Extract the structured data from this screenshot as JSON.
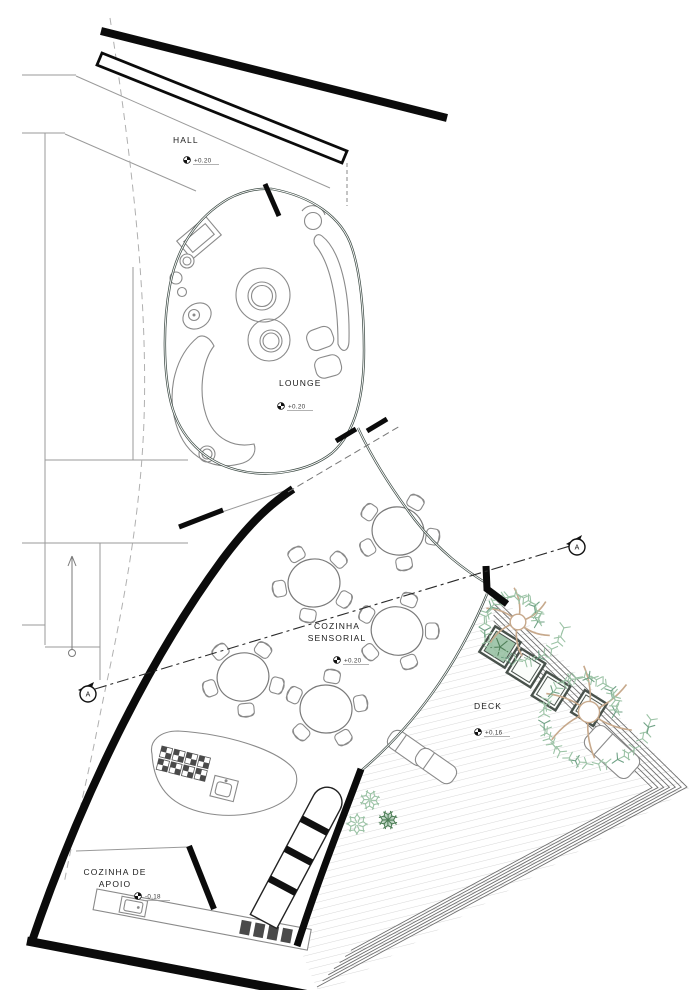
{
  "rooms": {
    "hall": {
      "name": "HALL",
      "level": "+0.20"
    },
    "lounge": {
      "name": "LOUNGE",
      "level": "+0.20"
    },
    "sensorial": {
      "line1": "COZINHA",
      "line2": "SENSORIAL",
      "level": "+0.20"
    },
    "deck": {
      "name": "DECK",
      "level": "+0.16"
    },
    "apoio": {
      "line1": "COZINHA DE",
      "line2": "APOIO",
      "level": "-0.18"
    }
  },
  "section": {
    "label": "A"
  },
  "colors": {
    "wall": "#0b0b0b",
    "glass": "#3f4d47",
    "foliage_light": "#9cc3a6",
    "foliage_dark": "#6fa185",
    "bush_dark": "#4f7f58",
    "branch": "#c7a98c",
    "planter": "#49524c",
    "deck_hatch": "#d8d8d8"
  },
  "plan": {
    "tables": [
      {
        "cx": 398,
        "cy": 531,
        "rx": 26,
        "ry": 24,
        "rot": 12,
        "chairs": [
          -60,
          10,
          80,
          150,
          215
        ]
      },
      {
        "cx": 314,
        "cy": 583,
        "rx": 26,
        "ry": 24,
        "rot": -8,
        "chairs": [
          -45,
          30,
          100,
          170,
          240
        ]
      },
      {
        "cx": 397,
        "cy": 631,
        "rx": 26,
        "ry": 24,
        "rot": 20,
        "chairs": [
          -70,
          0,
          70,
          140,
          210
        ]
      },
      {
        "cx": 243,
        "cy": 677,
        "rx": 26,
        "ry": 24,
        "rot": -15,
        "chairs": [
          -55,
          15,
          85,
          160,
          230
        ]
      },
      {
        "cx": 326,
        "cy": 709,
        "rx": 26,
        "ry": 24,
        "rot": 5,
        "chairs": [
          -80,
          -10,
          60,
          135,
          205
        ]
      }
    ],
    "trees": [
      {
        "cx": 518,
        "cy": 622,
        "r": 46
      },
      {
        "cx": 589,
        "cy": 712,
        "r": 62
      }
    ],
    "planters": [
      {
        "cx": 500,
        "cy": 647,
        "s": 30,
        "rot": 32,
        "green": true
      },
      {
        "cx": 526,
        "cy": 668,
        "s": 28,
        "rot": 32,
        "green": false
      },
      {
        "cx": 551,
        "cy": 691,
        "s": 28,
        "rot": 32,
        "green": false
      },
      {
        "cx": 589,
        "cy": 708,
        "s": 26,
        "rot": 32,
        "green": false
      }
    ],
    "bushes": [
      {
        "cx": 370,
        "cy": 800,
        "r": 11,
        "dark": false
      },
      {
        "cx": 357,
        "cy": 824,
        "r": 12,
        "dark": false
      },
      {
        "cx": 388,
        "cy": 820,
        "r": 10,
        "dark": true
      },
      {
        "cx": 258,
        "cy": 786,
        "r": 14,
        "dark": false
      },
      {
        "cx": 270,
        "cy": 797,
        "r": 9,
        "dark": true
      }
    ],
    "pots": [
      {
        "cx": 268,
        "cy": 795,
        "r": 10
      }
    ],
    "loungers": [
      {
        "cx": 408,
        "cy": 748,
        "w": 44,
        "h": 20,
        "rot": 35
      },
      {
        "cx": 436,
        "cy": 766,
        "w": 44,
        "h": 20,
        "rot": 35
      },
      {
        "cx": 612,
        "cy": 752,
        "w": 58,
        "h": 28,
        "rot": 42
      }
    ],
    "deck_steps": {
      "outer": [
        [
          493,
          597
        ],
        [
          687,
          787
        ],
        [
          317,
          987
        ]
      ],
      "count": 7,
      "inset": 0.031
    }
  }
}
